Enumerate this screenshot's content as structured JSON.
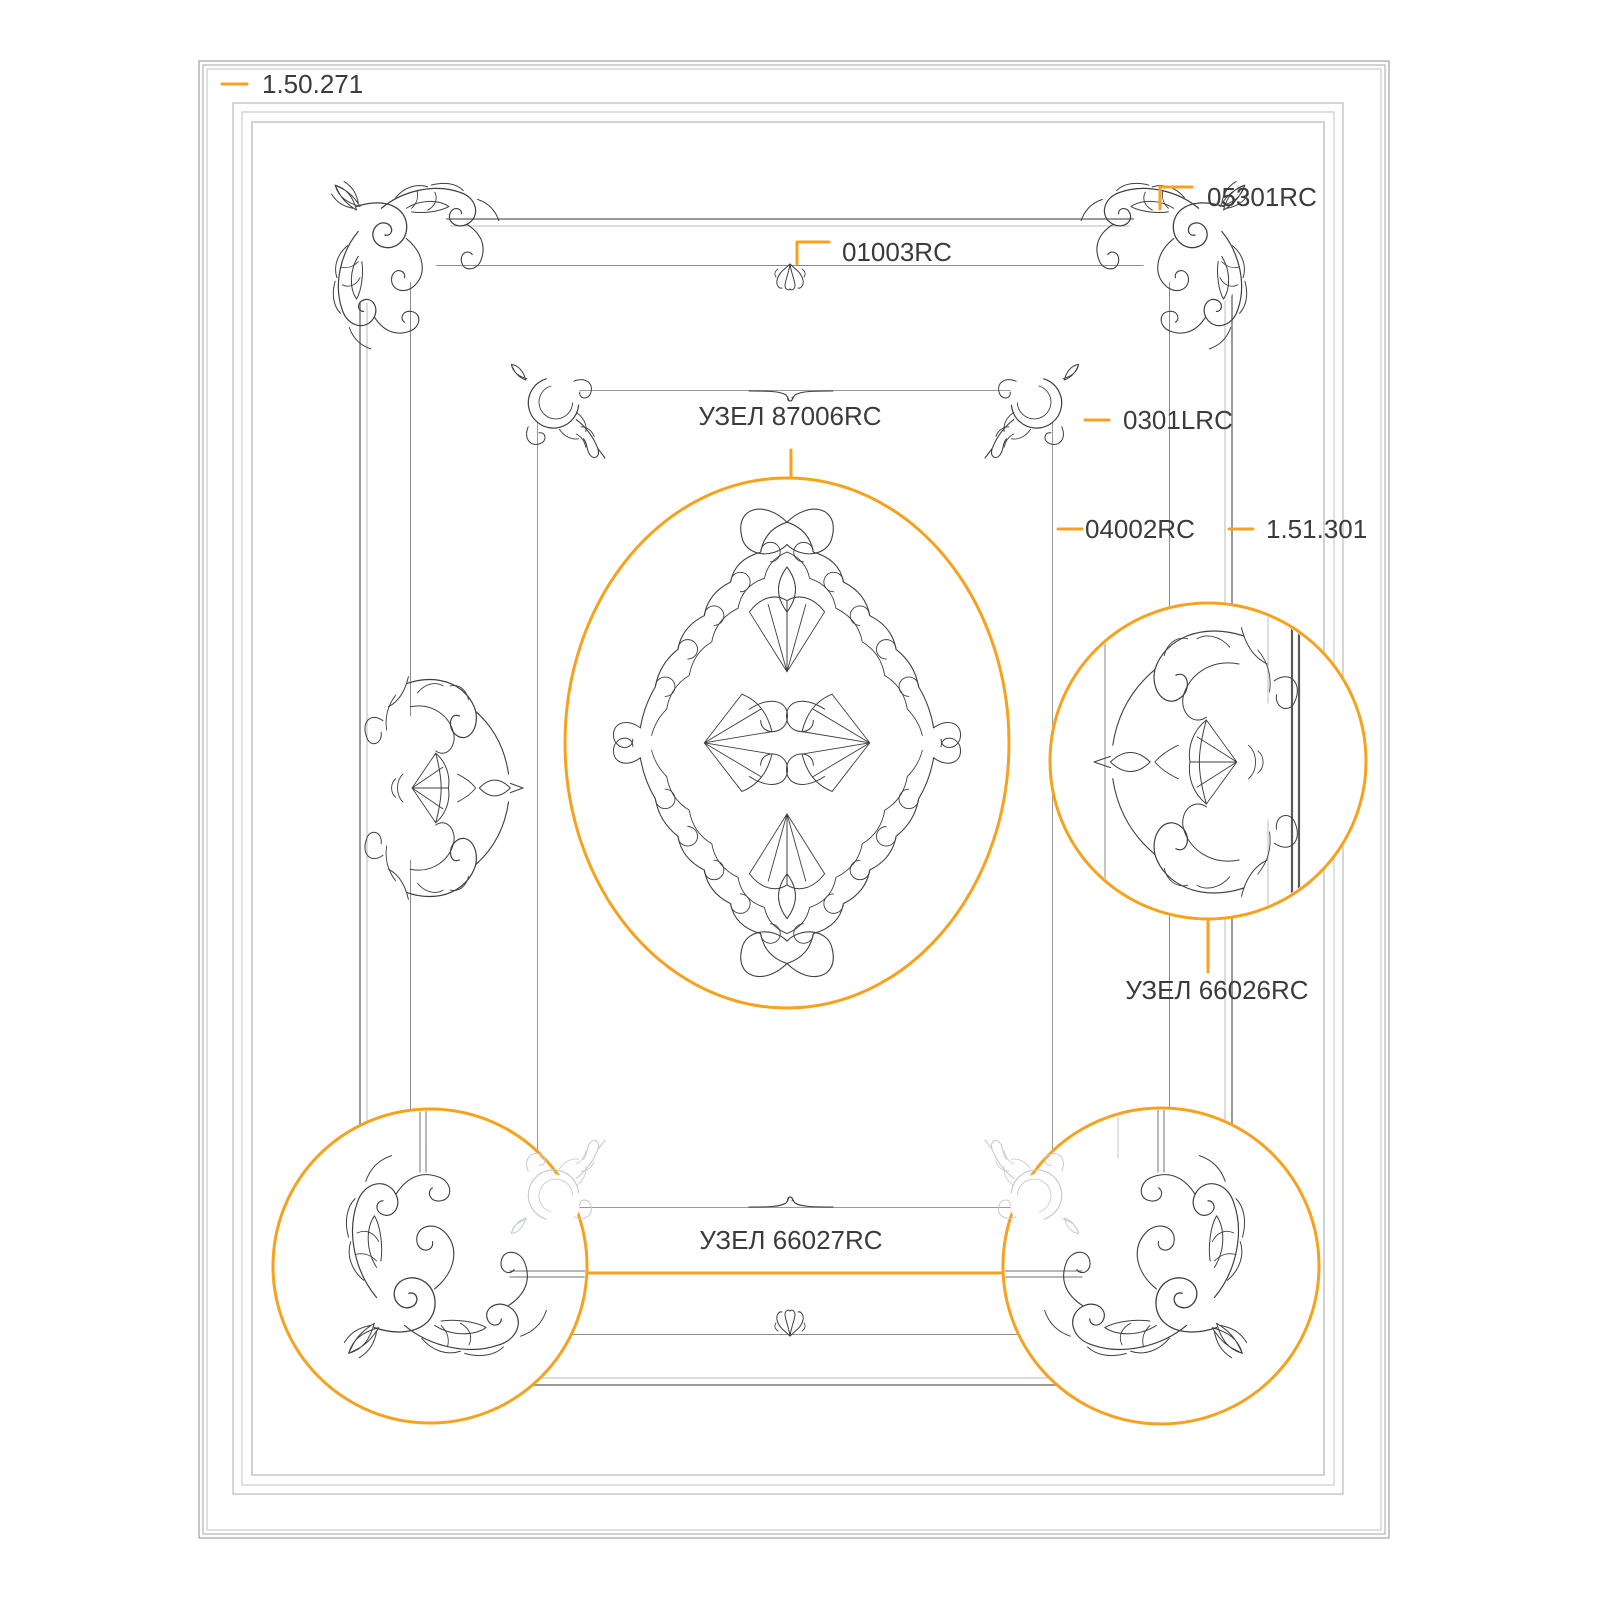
{
  "drawing": {
    "type": "ceiling molding installation diagram",
    "colors": {
      "accent_orange": "#F6A21E",
      "ornament_line": "#3F3F3F",
      "frame_gray": "#9A9A9A",
      "faded_line": "#C6CBD1",
      "text": "#3B3B3B",
      "background": "#FFFFFF"
    },
    "labels": {
      "outer_frame_code": "1.50.271",
      "corner_ornament_code": "05301RC",
      "inner_frame_code": "01003RC",
      "center_detail_code": "УЗЕЛ 87006RC",
      "panel_corner_code": "0301LRC",
      "panel_frame_code": "04002RC",
      "cornice_code": "1.51.301",
      "side_detail_code": "УЗЕЛ 66026RC",
      "bottom_detail_code": "УЗЕЛ 66027RC"
    }
  }
}
